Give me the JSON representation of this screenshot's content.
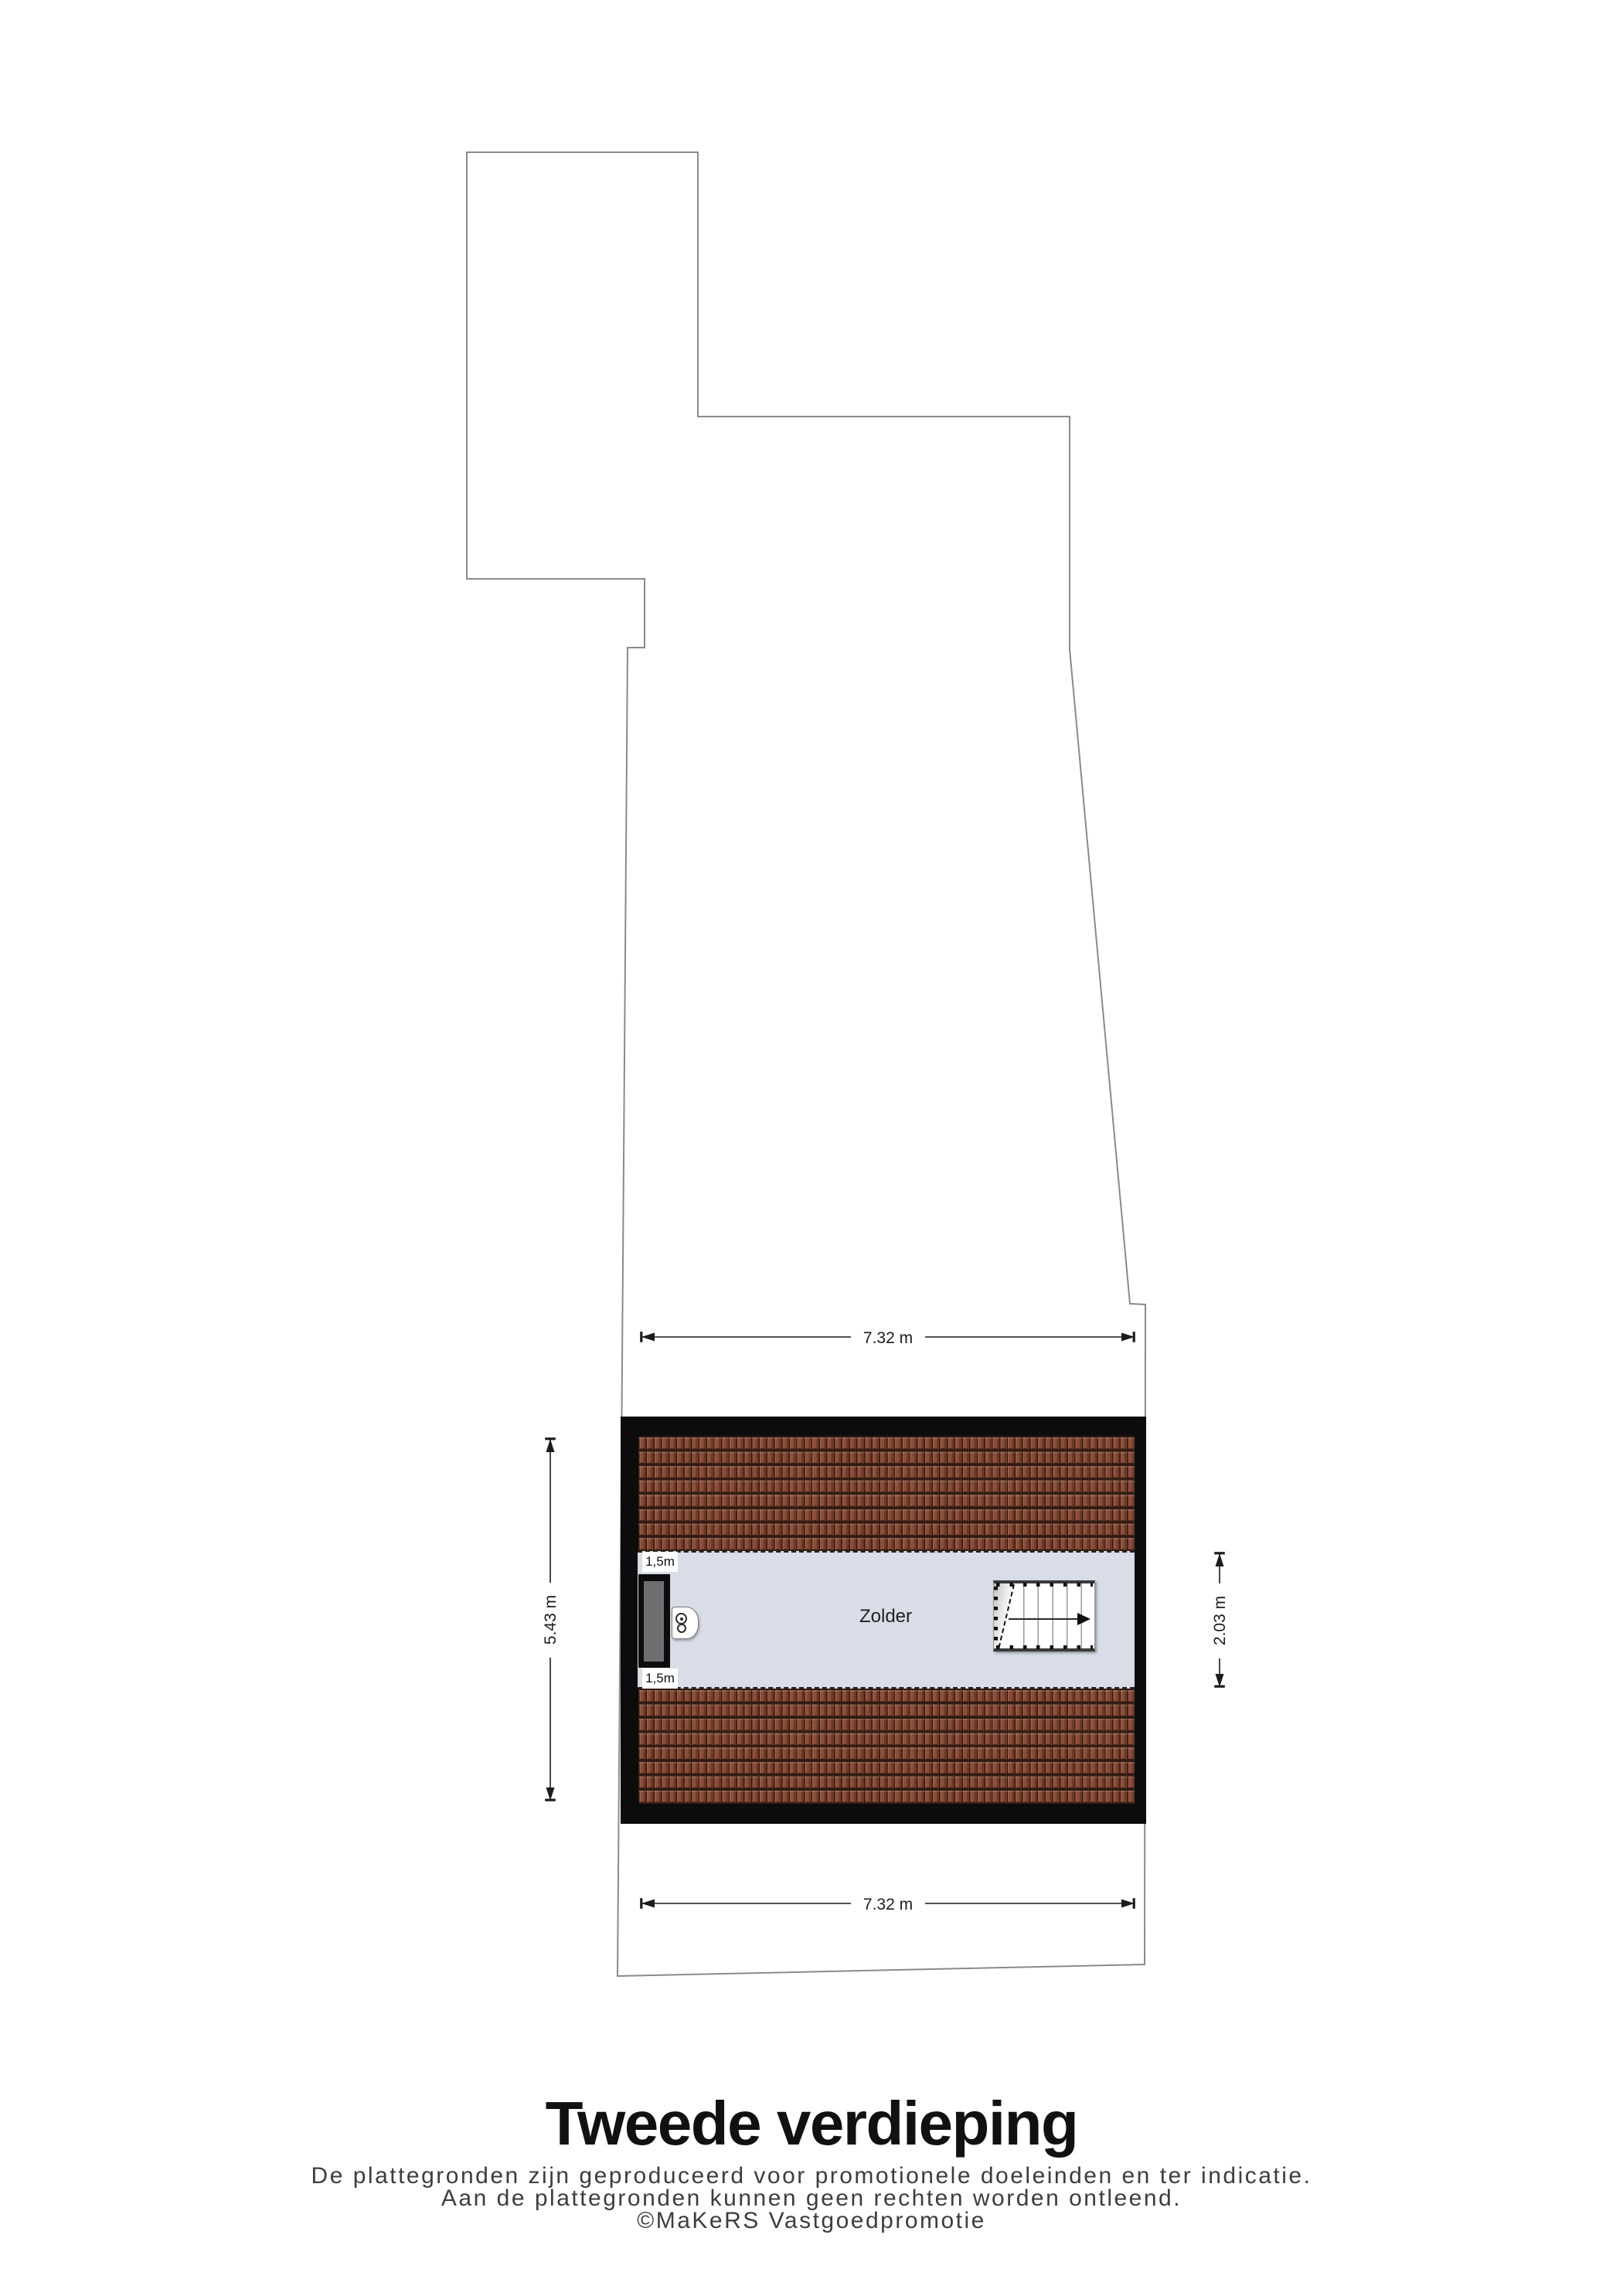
{
  "title": {
    "text": "Tweede verdieping"
  },
  "disclaimer": {
    "line1": "De plattegronden zijn geproduceerd voor promotionele doeleinden en ter indicatie.",
    "line2": "Aan de plattegronden kunnen geen rechten worden ontleend.",
    "line3": "©MaKeRS Vastgoedpromotie"
  },
  "floor_plan": {
    "room_label": "Zolder",
    "dimensions": {
      "width_top": "7.32 m",
      "width_bottom": "7.32 m",
      "height_left": "5.43 m",
      "depth_right": "2.03 m"
    },
    "headroom": {
      "top": "1,5m",
      "bottom": "1,5m"
    },
    "icons": {
      "window": "dormer-window-icon",
      "heater": "boiler-icon",
      "stairs": "staircase-icon",
      "stairs_arrow": "direction-arrow-icon"
    },
    "colors": {
      "wall": "#0c0c0c",
      "roof_tile": "#8a4c38",
      "roof_tile_dark": "#2f1d15",
      "floor": "#d8dde8",
      "window_glass": "#6e6e6e",
      "outline": "#8a8a8a",
      "dimension": "#1c1c1c"
    }
  }
}
